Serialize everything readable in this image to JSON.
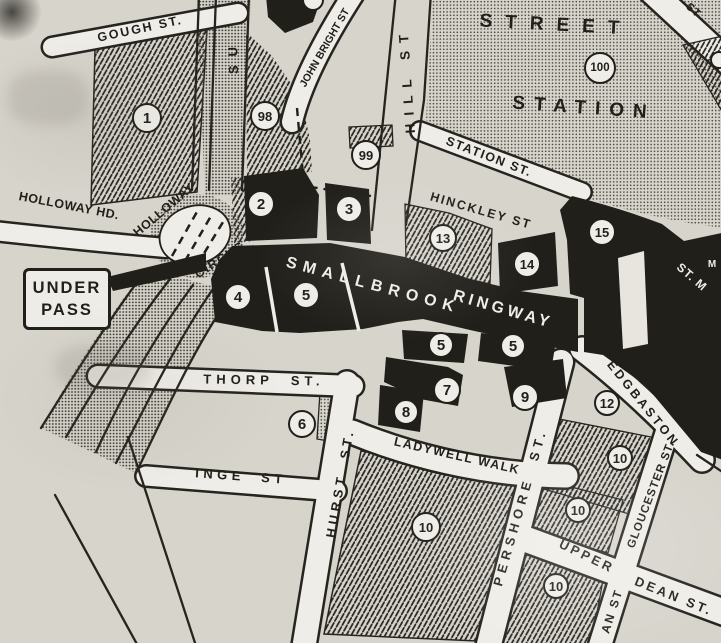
{
  "colors": {
    "paper": "#d7d4cc",
    "ink": "#211f1a",
    "road_white": "#efede7"
  },
  "signs": {
    "underpass": {
      "line1": "UNDER",
      "line2": "PASS"
    }
  },
  "street_labels": [
    {
      "id": "gough-st",
      "text": "GOUGH ST.",
      "x": 140,
      "y": 29,
      "rotate": -12,
      "size": 12.5,
      "spacing": 2,
      "tone": "dark"
    },
    {
      "id": "holloway-hd",
      "text": "HOLLOWAY HD.",
      "x": 69,
      "y": 206,
      "rotate": 11,
      "size": 12.5,
      "spacing": 0.5,
      "tone": "dark"
    },
    {
      "id": "holloway",
      "text": "HOLLOWAY",
      "x": 164,
      "y": 210,
      "rotate": -40,
      "size": 12.5,
      "spacing": 0.5,
      "tone": "dark"
    },
    {
      "id": "circus",
      "text": "CIRCUS",
      "x": 220,
      "y": 260,
      "rotate": -33,
      "size": 12.5,
      "spacing": 1.5,
      "tone": "dark"
    },
    {
      "id": "suffolk-partial",
      "text": "SU",
      "x": 233,
      "y": 56,
      "rotate": -92,
      "size": 13,
      "spacing": 9,
      "tone": "dark"
    },
    {
      "id": "john-bright-st",
      "text": "JOHN BRIGHT ST",
      "x": 325,
      "y": 48,
      "rotate": -60,
      "size": 10.5,
      "spacing": 0,
      "tone": "dark"
    },
    {
      "id": "hill-st",
      "text": "HILL ST",
      "x": 407,
      "y": 80,
      "rotate": -94,
      "size": 13.5,
      "spacing": 8,
      "tone": "dark"
    },
    {
      "id": "street",
      "text": "STREET",
      "x": 556,
      "y": 25,
      "rotate": 3,
      "size": 19,
      "spacing": 13,
      "tone": "dark"
    },
    {
      "id": "station",
      "text": "STATION",
      "x": 584,
      "y": 108,
      "rotate": 4,
      "size": 19,
      "spacing": 9,
      "tone": "dark"
    },
    {
      "id": "station-st",
      "text": "STATION ST.",
      "x": 489,
      "y": 157,
      "rotate": 21,
      "size": 12.5,
      "spacing": 1.5,
      "tone": "dark"
    },
    {
      "id": "hinckley-st",
      "text": "HINCKLEY ST",
      "x": 481,
      "y": 211,
      "rotate": 16,
      "size": 12.5,
      "spacing": 2,
      "tone": "dark"
    },
    {
      "id": "smallbrook",
      "text": "SMALLBROOK",
      "x": 373,
      "y": 286,
      "rotate": 15,
      "size": 16,
      "spacing": 6.5,
      "tone": "light"
    },
    {
      "id": "ringway",
      "text": "RINGWAY",
      "x": 503,
      "y": 310,
      "rotate": 16,
      "size": 16,
      "spacing": 4,
      "tone": "light"
    },
    {
      "id": "st-m",
      "text": "ST. M",
      "x": 692,
      "y": 277,
      "rotate": 41,
      "size": 12,
      "spacing": 1,
      "tone": "light"
    },
    {
      "id": "st-topright",
      "text": "ST",
      "x": 693,
      "y": 11,
      "rotate": 42,
      "size": 11,
      "spacing": 1,
      "tone": "dark"
    },
    {
      "id": "thorp-st",
      "text": "THORP  ST.",
      "x": 264,
      "y": 380,
      "rotate": 1,
      "size": 13,
      "spacing": 5,
      "tone": "dark"
    },
    {
      "id": "inge-st",
      "text": "INGE  ST",
      "x": 241,
      "y": 476,
      "rotate": 4,
      "size": 13,
      "spacing": 4.5,
      "tone": "dark"
    },
    {
      "id": "hurst-st",
      "text": "HURST  ST.",
      "x": 340,
      "y": 483,
      "rotate": -80,
      "size": 13,
      "spacing": 4,
      "tone": "dark"
    },
    {
      "id": "ladywell-walk",
      "text": "LADYWELL WALK",
      "x": 457,
      "y": 456,
      "rotate": 13,
      "size": 12.5,
      "spacing": 1.5,
      "tone": "dark"
    },
    {
      "id": "pershore-st",
      "text": "PERSHORE  ST.",
      "x": 520,
      "y": 507,
      "rotate": -74,
      "size": 13,
      "spacing": 5,
      "tone": "dark"
    },
    {
      "id": "edgbaston",
      "text": "EDGBASTON",
      "x": 643,
      "y": 404,
      "rotate": 51,
      "size": 12.5,
      "spacing": 3,
      "tone": "dark"
    },
    {
      "id": "gloucester-st",
      "text": "GLOUCESTER ST.",
      "x": 652,
      "y": 495,
      "rotate": -69,
      "size": 11.5,
      "spacing": 1,
      "tone": "dark"
    },
    {
      "id": "upper",
      "text": "UPPER",
      "x": 587,
      "y": 556,
      "rotate": 26,
      "size": 13,
      "spacing": 3,
      "tone": "dark"
    },
    {
      "id": "dean-st",
      "text": "DEAN ST.",
      "x": 674,
      "y": 596,
      "rotate": 22,
      "size": 13,
      "spacing": 3,
      "tone": "dark"
    },
    {
      "id": "an-st-partial",
      "text": "AN ST",
      "x": 612,
      "y": 611,
      "rotate": -72,
      "size": 12,
      "spacing": 2,
      "tone": "dark"
    }
  ],
  "circled_numbers": [
    {
      "value": "1",
      "x": 147,
      "y": 118,
      "r": 15
    },
    {
      "value": "98",
      "x": 265,
      "y": 116,
      "r": 15
    },
    {
      "value": "99",
      "x": 366,
      "y": 155,
      "r": 15
    },
    {
      "value": "100",
      "x": 600,
      "y": 68,
      "r": 16
    },
    {
      "value": "2",
      "x": 261,
      "y": 204,
      "r": 14
    },
    {
      "value": "3",
      "x": 349,
      "y": 209,
      "r": 14
    },
    {
      "value": "13",
      "x": 443,
      "y": 238,
      "r": 14
    },
    {
      "value": "14",
      "x": 527,
      "y": 264,
      "r": 14
    },
    {
      "value": "15",
      "x": 602,
      "y": 232,
      "r": 14
    },
    {
      "value": "4",
      "x": 238,
      "y": 297,
      "r": 14
    },
    {
      "value": "5",
      "x": 306,
      "y": 295,
      "r": 14
    },
    {
      "value": "5",
      "x": 441,
      "y": 345,
      "r": 13
    },
    {
      "value": "5",
      "x": 513,
      "y": 346,
      "r": 13
    },
    {
      "value": "7",
      "x": 447,
      "y": 390,
      "r": 14
    },
    {
      "value": "8",
      "x": 406,
      "y": 412,
      "r": 13
    },
    {
      "value": "9",
      "x": 525,
      "y": 397,
      "r": 14
    },
    {
      "value": "6",
      "x": 302,
      "y": 424,
      "r": 14
    },
    {
      "value": "12",
      "x": 607,
      "y": 403,
      "r": 13
    },
    {
      "value": "10",
      "x": 426,
      "y": 527,
      "r": 15
    },
    {
      "value": "10",
      "x": 620,
      "y": 458,
      "r": 13
    },
    {
      "value": "10",
      "x": 578,
      "y": 510,
      "r": 13
    },
    {
      "value": "10",
      "x": 556,
      "y": 586,
      "r": 13
    }
  ],
  "partial_circles": [
    {
      "x": 313,
      "y": 0,
      "r": 11
    },
    {
      "x": 719,
      "y": 60,
      "r": 9
    }
  ],
  "markers": [
    {
      "id": "st-martins-symbol",
      "glyph": "M",
      "x": 712,
      "y": 264,
      "r": 10
    }
  ]
}
